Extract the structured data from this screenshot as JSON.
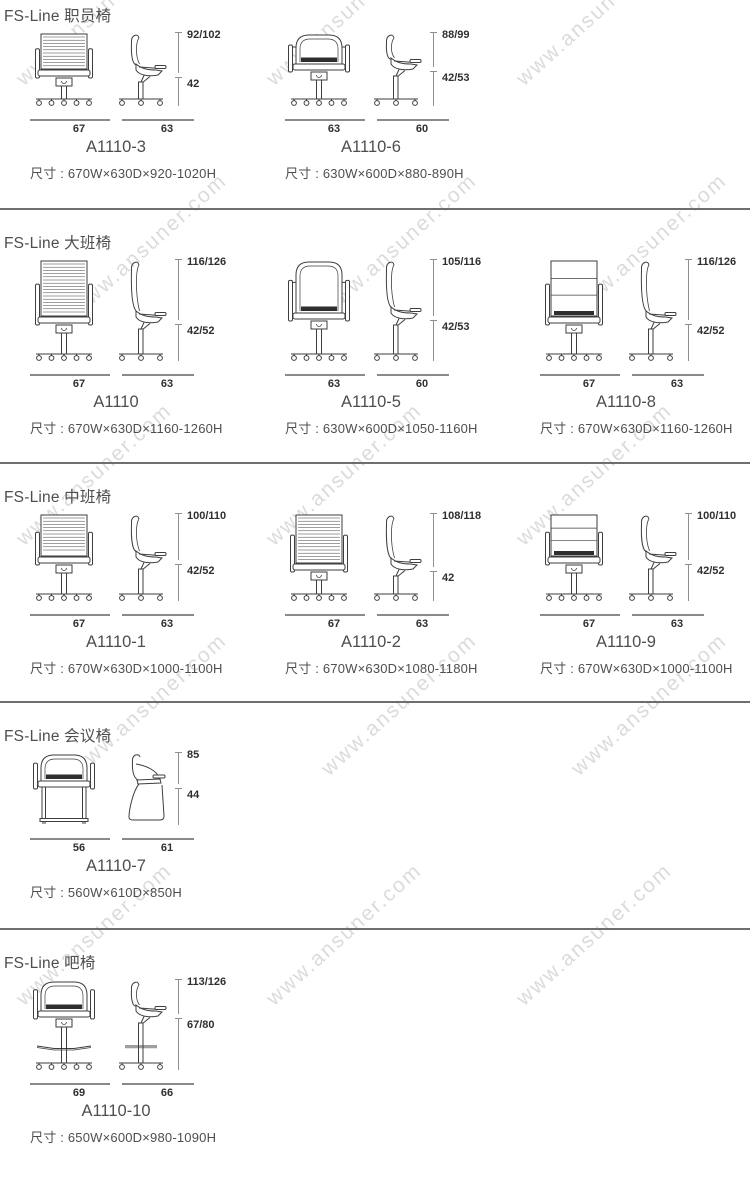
{
  "page": {
    "background": "#ffffff"
  },
  "watermark": {
    "text": "www.ansuner.com",
    "color": "#dbdbdb"
  },
  "styles": {
    "drawing_line_color": "#3e3e3e",
    "dimension_line_color": "#8f8f8f",
    "dimension_label_color": "#2f2f2f",
    "text_color": "#4e4e4e",
    "separator_color": "#6e6e6e"
  },
  "sections": [
    {
      "title": "FS-Line 职员椅",
      "models": [
        {
          "model": "A1110-3",
          "height_labels": [
            "92/102",
            "42"
          ],
          "width_labels": [
            "67",
            "63"
          ],
          "size_label": "尺寸 : 670W×630D×920-1020H",
          "front_style": "ribbed-back-front",
          "side_style": "task-chair-side"
        },
        {
          "model": "A1110-6",
          "height_labels": [
            "88/99",
            "42/53"
          ],
          "width_labels": [
            "63",
            "60"
          ],
          "size_label": "尺寸 : 630W×600D×880-890H",
          "front_style": "round-back-front",
          "side_style": "task-chair-side"
        }
      ]
    },
    {
      "title": "FS-Line 大班椅",
      "models": [
        {
          "model": "A1110",
          "height_labels": [
            "116/126",
            "42/52"
          ],
          "width_labels": [
            "67",
            "63"
          ],
          "size_label": "尺寸 : 670W×630D×1160-1260H",
          "front_style": "ribbed-back-front",
          "side_style": "task-chair-side"
        },
        {
          "model": "A1110-5",
          "height_labels": [
            "105/116",
            "42/53"
          ],
          "width_labels": [
            "63",
            "60"
          ],
          "size_label": "尺寸 : 630W×600D×1050-1160H",
          "front_style": "round-back-front",
          "side_style": "task-chair-side"
        },
        {
          "model": "A1110-8",
          "height_labels": [
            "116/126",
            "42/52"
          ],
          "width_labels": [
            "67",
            "63"
          ],
          "size_label": "尺寸 : 670W×630D×1160-1260H",
          "front_style": "panel-back-front",
          "side_style": "task-chair-side"
        }
      ]
    },
    {
      "title": "FS-Line 中班椅",
      "models": [
        {
          "model": "A1110-1",
          "height_labels": [
            "100/110",
            "42/52"
          ],
          "width_labels": [
            "67",
            "63"
          ],
          "size_label": "尺寸 : 670W×630D×1000-1100H",
          "front_style": "ribbed-back-front",
          "side_style": "task-chair-side"
        },
        {
          "model": "A1110-2",
          "height_labels": [
            "108/118",
            "42"
          ],
          "width_labels": [
            "67",
            "63"
          ],
          "size_label": "尺寸 : 670W×630D×1080-1180H",
          "front_style": "ribbed-back-front",
          "side_style": "task-chair-side"
        },
        {
          "model": "A1110-9",
          "height_labels": [
            "100/110",
            "42/52"
          ],
          "width_labels": [
            "67",
            "63"
          ],
          "size_label": "尺寸 : 670W×630D×1000-1100H",
          "front_style": "panel-back-front",
          "side_style": "task-chair-side"
        }
      ]
    },
    {
      "title": "FS-Line 会议椅",
      "models": [
        {
          "model": "A1110-7",
          "height_labels": [
            "85",
            "44"
          ],
          "width_labels": [
            "56",
            "61"
          ],
          "size_label": "尺寸 : 560W×610D×850H",
          "front_style": "sled-base-front",
          "side_style": "cantilever-side"
        }
      ]
    },
    {
      "title": "FS-Line 吧椅",
      "models": [
        {
          "model": "A1110-10",
          "height_labels": [
            "113/126",
            "67/80"
          ],
          "width_labels": [
            "69",
            "66"
          ],
          "size_label": "尺寸 : 650W×600D×980-1090H",
          "front_style": "bar-stool-front",
          "side_style": "bar-stool-side"
        }
      ]
    }
  ]
}
